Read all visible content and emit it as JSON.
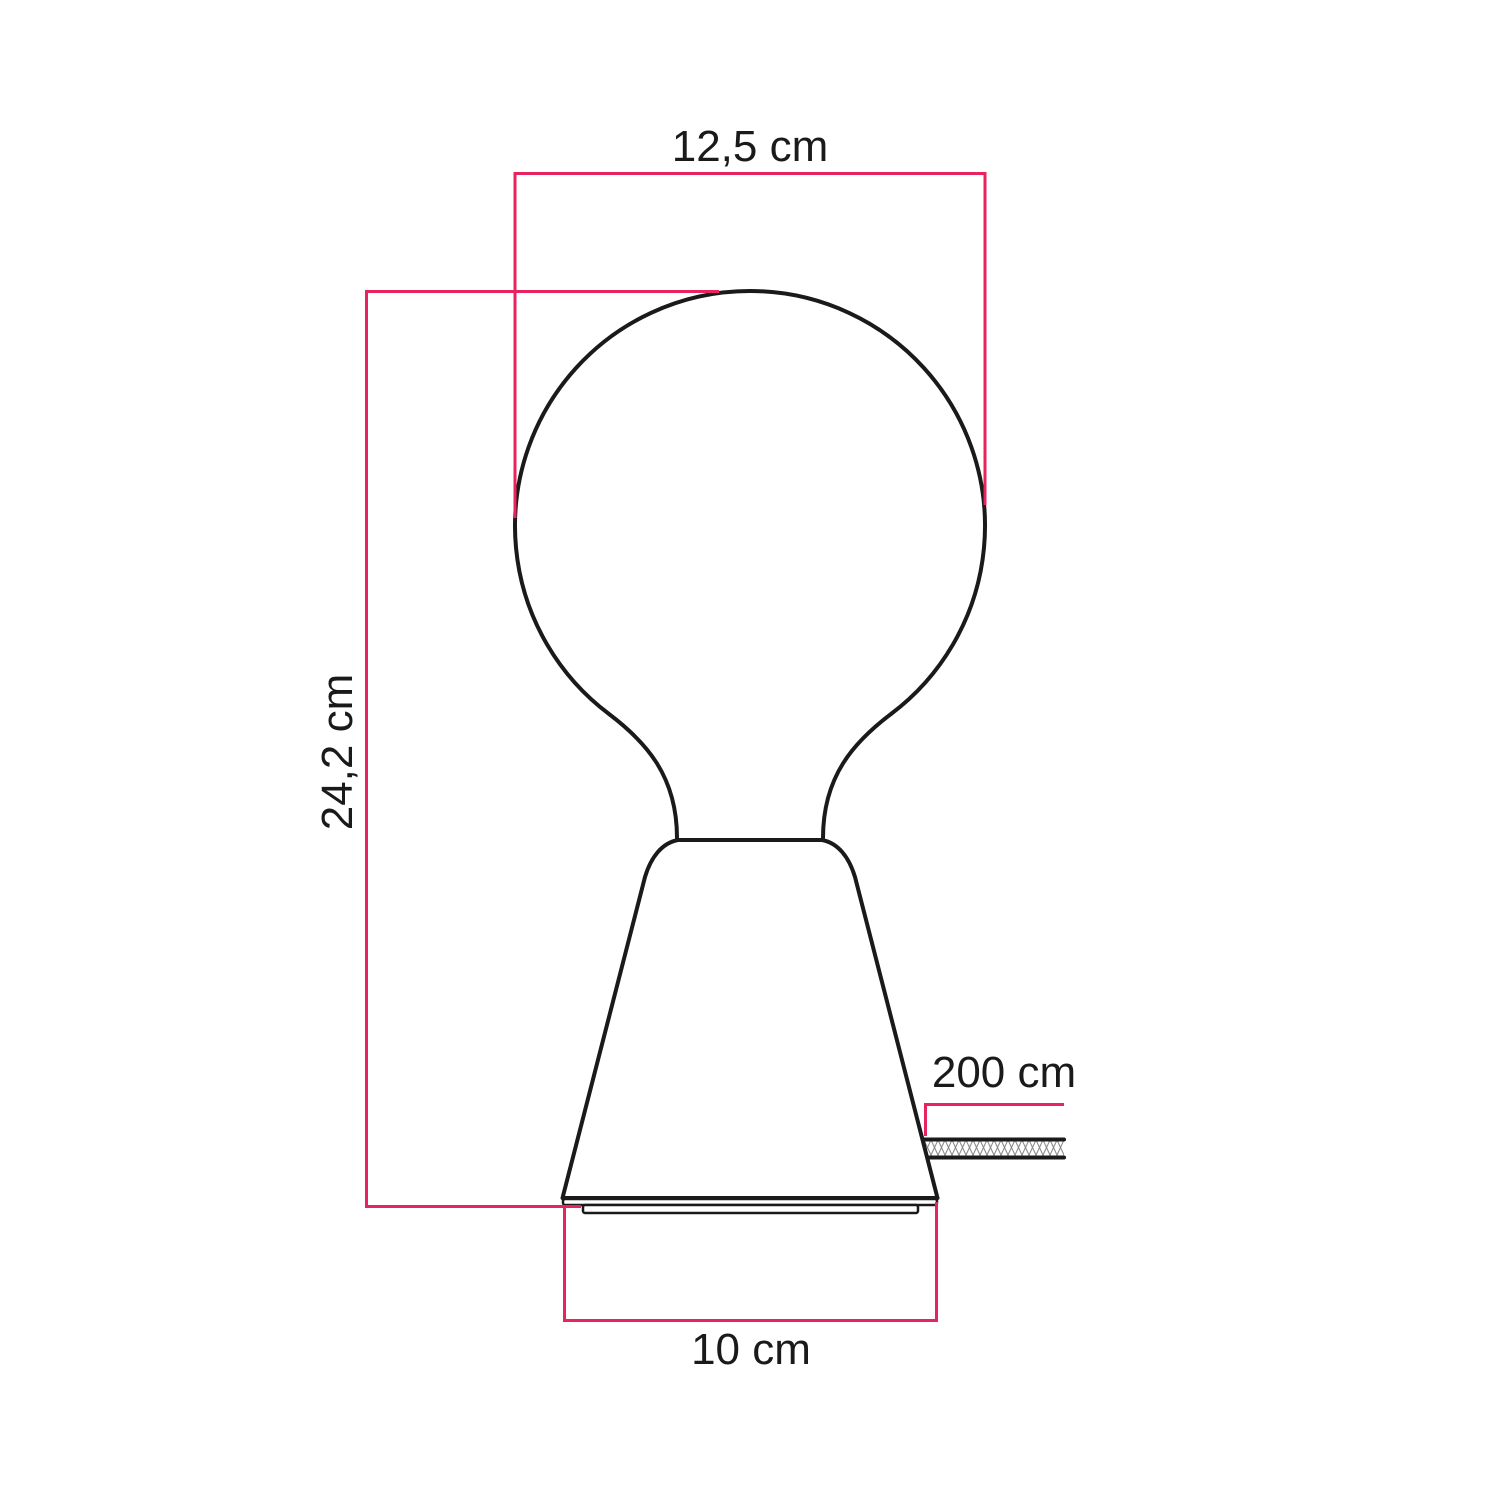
{
  "labels": {
    "bulb_width": "12,5 cm",
    "total_height": "24,2 cm",
    "cable_length": "200 cm",
    "base_width": "10 cm"
  },
  "colors": {
    "dimension_line": "#e8235f",
    "outline": "#1a1a1a",
    "background": "#ffffff"
  }
}
